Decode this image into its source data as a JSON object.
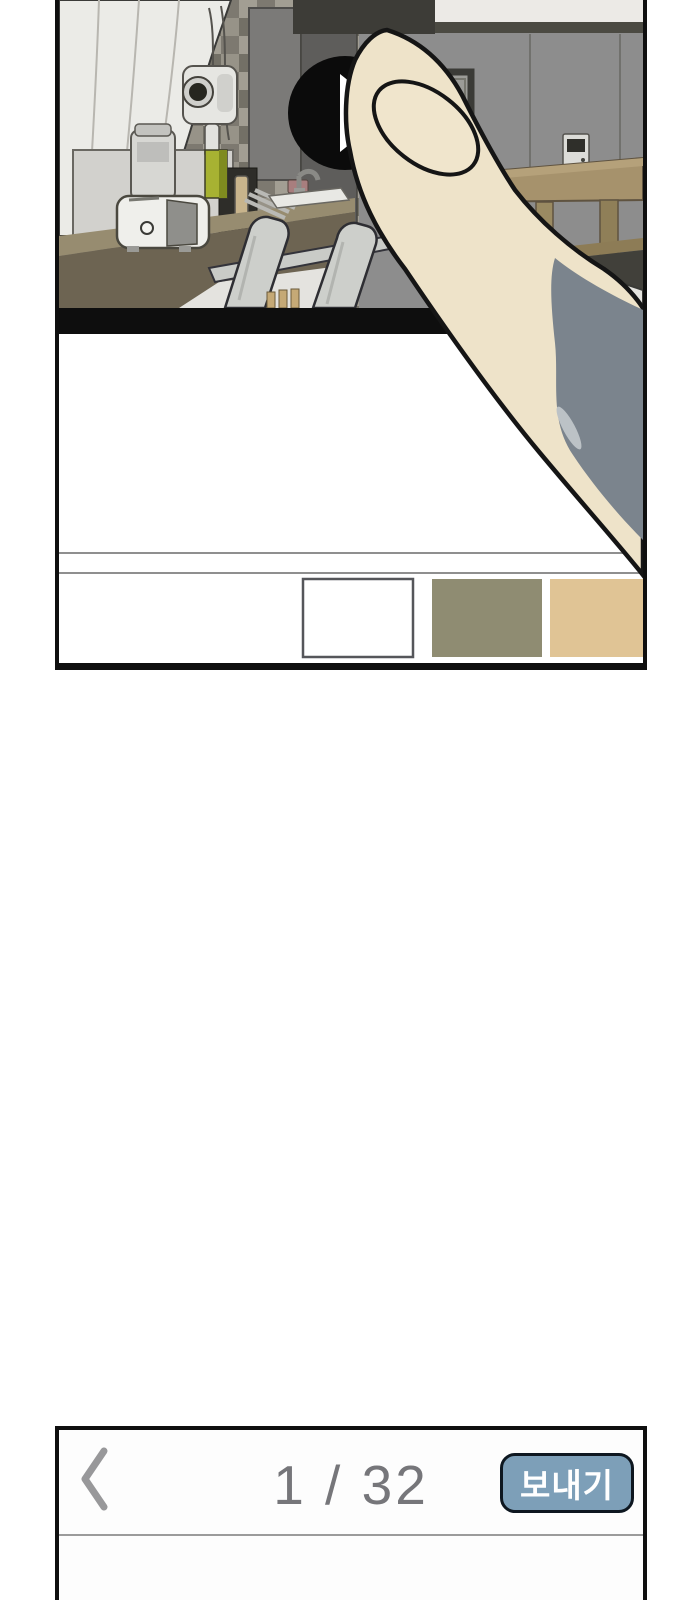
{
  "viewer": {
    "background": "#ffffff"
  },
  "comic_panel": {
    "border_color": "#0f0f0f",
    "video_frame": {
      "play_button": {
        "color": "#0b0b0b",
        "triangle_color": "#ffffff"
      },
      "divider_bar_color": "#0e0e0e"
    },
    "finger": {
      "skin_color": "#eee3c9",
      "nail_color": "#f0e5cc",
      "sleeve_color": "#7b848d",
      "outline_color": "#151515"
    },
    "palette": {
      "separator_color": "#8f8f8f",
      "swatches": [
        {
          "id": "swatch-white",
          "color": "#ffffff",
          "border_color": "#55565a"
        },
        {
          "id": "swatch-olive",
          "color": "#8f8c72"
        },
        {
          "id": "swatch-tan",
          "color": "#e0c495"
        }
      ]
    },
    "scene_colors": {
      "wall": "#8d8d8d",
      "tile_light": "#a29e93",
      "tile_dark": "#737066",
      "counter_front": "#6d6452",
      "counter_top": "#978c70",
      "curtain": "#ebebe7",
      "table_wood": "#a6926c",
      "chair": "#cdcfcb",
      "dryer_green": "#a7b232"
    }
  },
  "pager_bar": {
    "back_icon": "chevron-left",
    "chevron_color": "#98989a",
    "page_indicator": "1 / 32",
    "page_current": "1",
    "page_total": "32",
    "indicator_color": "#76767a",
    "separator_color": "#9b9b9b",
    "border_color": "#0f0f0f",
    "send_button": {
      "label": "보내기",
      "background": "#7d9fb8",
      "border_color": "#0e1720",
      "text_color": "#ffffff"
    }
  }
}
